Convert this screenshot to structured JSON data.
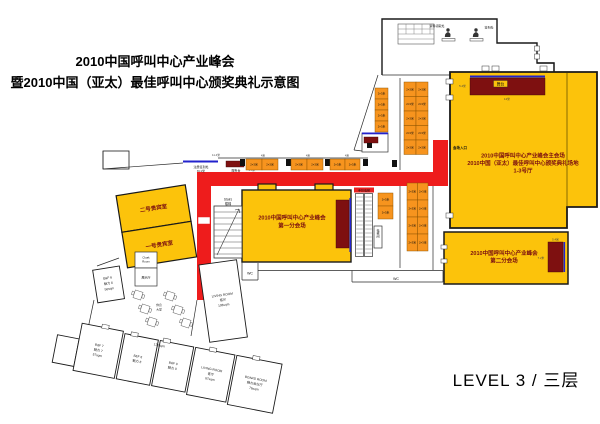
{
  "title": {
    "line1": "2010中国呼叫中心产业峰会",
    "line2": "暨2010中国（亚太）最佳呼叫中心颁奖典礼示意图"
  },
  "level_label": "LEVEL 3 / 三层",
  "colors": {
    "room_yellow": "#FCC30B",
    "booth_orange": "#F7941E",
    "corridor_red": "#EE1C1C",
    "stage_maroon": "#7E1010",
    "line_blue": "#2222CC",
    "venue_text_maroon": "#7B1010"
  },
  "main_hall": {
    "line1": "2010中国呼叫中心产业峰会主会场",
    "line2": "2010中国（亚太）最佳呼叫中心颁奖典礼场地",
    "line3": "1-3号厅",
    "stage_label": "舞台",
    "entrance_label": "会场入口",
    "stage_width_dim": "12米",
    "stage_depth_dim": "5.4米"
  },
  "sub_venue_1": {
    "line1": "2010中国呼叫中心产业峰会",
    "line2": "第一分会场"
  },
  "sub_venue_2": {
    "line1": "2010中国呼叫中心产业峰会",
    "line2": "第二分会场",
    "stage_width_dim": "5.4米",
    "stage_height_dim": "7.2米"
  },
  "vip_rooms": {
    "room2": "二号贵宾室",
    "room1": "一号贵宾室"
  },
  "registration_desk": {
    "line1": "注册签到处",
    "line2": "8×1米",
    "service_label": "服务台"
  },
  "lobby_top": {
    "material_label": "资料领取处",
    "signin_label": "签到处"
  },
  "stairs": {
    "en": "Stairs",
    "cn": "楼梯"
  },
  "escalator_label": "手扶电梯",
  "elevator_label": "电梯间",
  "wc_label": "WC",
  "rest_area": {
    "line1": "休息",
    "line2": "大堂"
  },
  "cloak_room": {
    "line1": "Cloak",
    "line2": "Room"
  },
  "display_room_label": "展示厅",
  "booths": {
    "size_label": "2×3米",
    "groups": [
      {
        "x": 246,
        "y": 159,
        "cols": 2,
        "rows": 1,
        "w": 16,
        "h": 11
      },
      {
        "x": 291,
        "y": 159,
        "cols": 2,
        "rows": 1,
        "w": 16,
        "h": 11
      },
      {
        "x": 330,
        "y": 159,
        "cols": 2,
        "rows": 1,
        "w": 15,
        "h": 11
      },
      {
        "x": 375,
        "y": 88,
        "cols": 1,
        "rows": 4,
        "w": 13,
        "h": 11
      },
      {
        "x": 404,
        "y": 82,
        "cols": 2,
        "rows": 5,
        "w": 12,
        "h": 14.5
      },
      {
        "x": 407,
        "y": 183,
        "cols": 2,
        "rows": 4,
        "w": 10.5,
        "h": 17
      },
      {
        "x": 378,
        "y": 193,
        "cols": 1,
        "rows": 2,
        "w": 15,
        "h": 13
      }
    ]
  },
  "rooms": {
    "bf6": {
      "en": "B&F 6",
      "cn": "魅力 6",
      "area": "56sqm"
    },
    "bf7": {
      "en": "B&F 7",
      "cn": "魅力 7",
      "area": "57sqm"
    },
    "bf8": {
      "en": "B&F 8",
      "cn": "魅力 8"
    },
    "bf9": {
      "en": "B&F 9",
      "cn": "魅力 9"
    },
    "living_bottom": {
      "en": "LIVING ROOM",
      "cn": "客厅",
      "area": "87sqm"
    },
    "board": {
      "en": "BOARD ROOM",
      "cn": "魅力会议厅",
      "area": "76sqm"
    },
    "living_right": {
      "en": "LIVING ROOM",
      "cn": "客厅",
      "area": "108sqm"
    },
    "mid_area_label": "125sqm"
  },
  "dims": {
    "d11_4": "11.4米",
    "d4": "4米",
    "d4_5": "4.5米"
  }
}
